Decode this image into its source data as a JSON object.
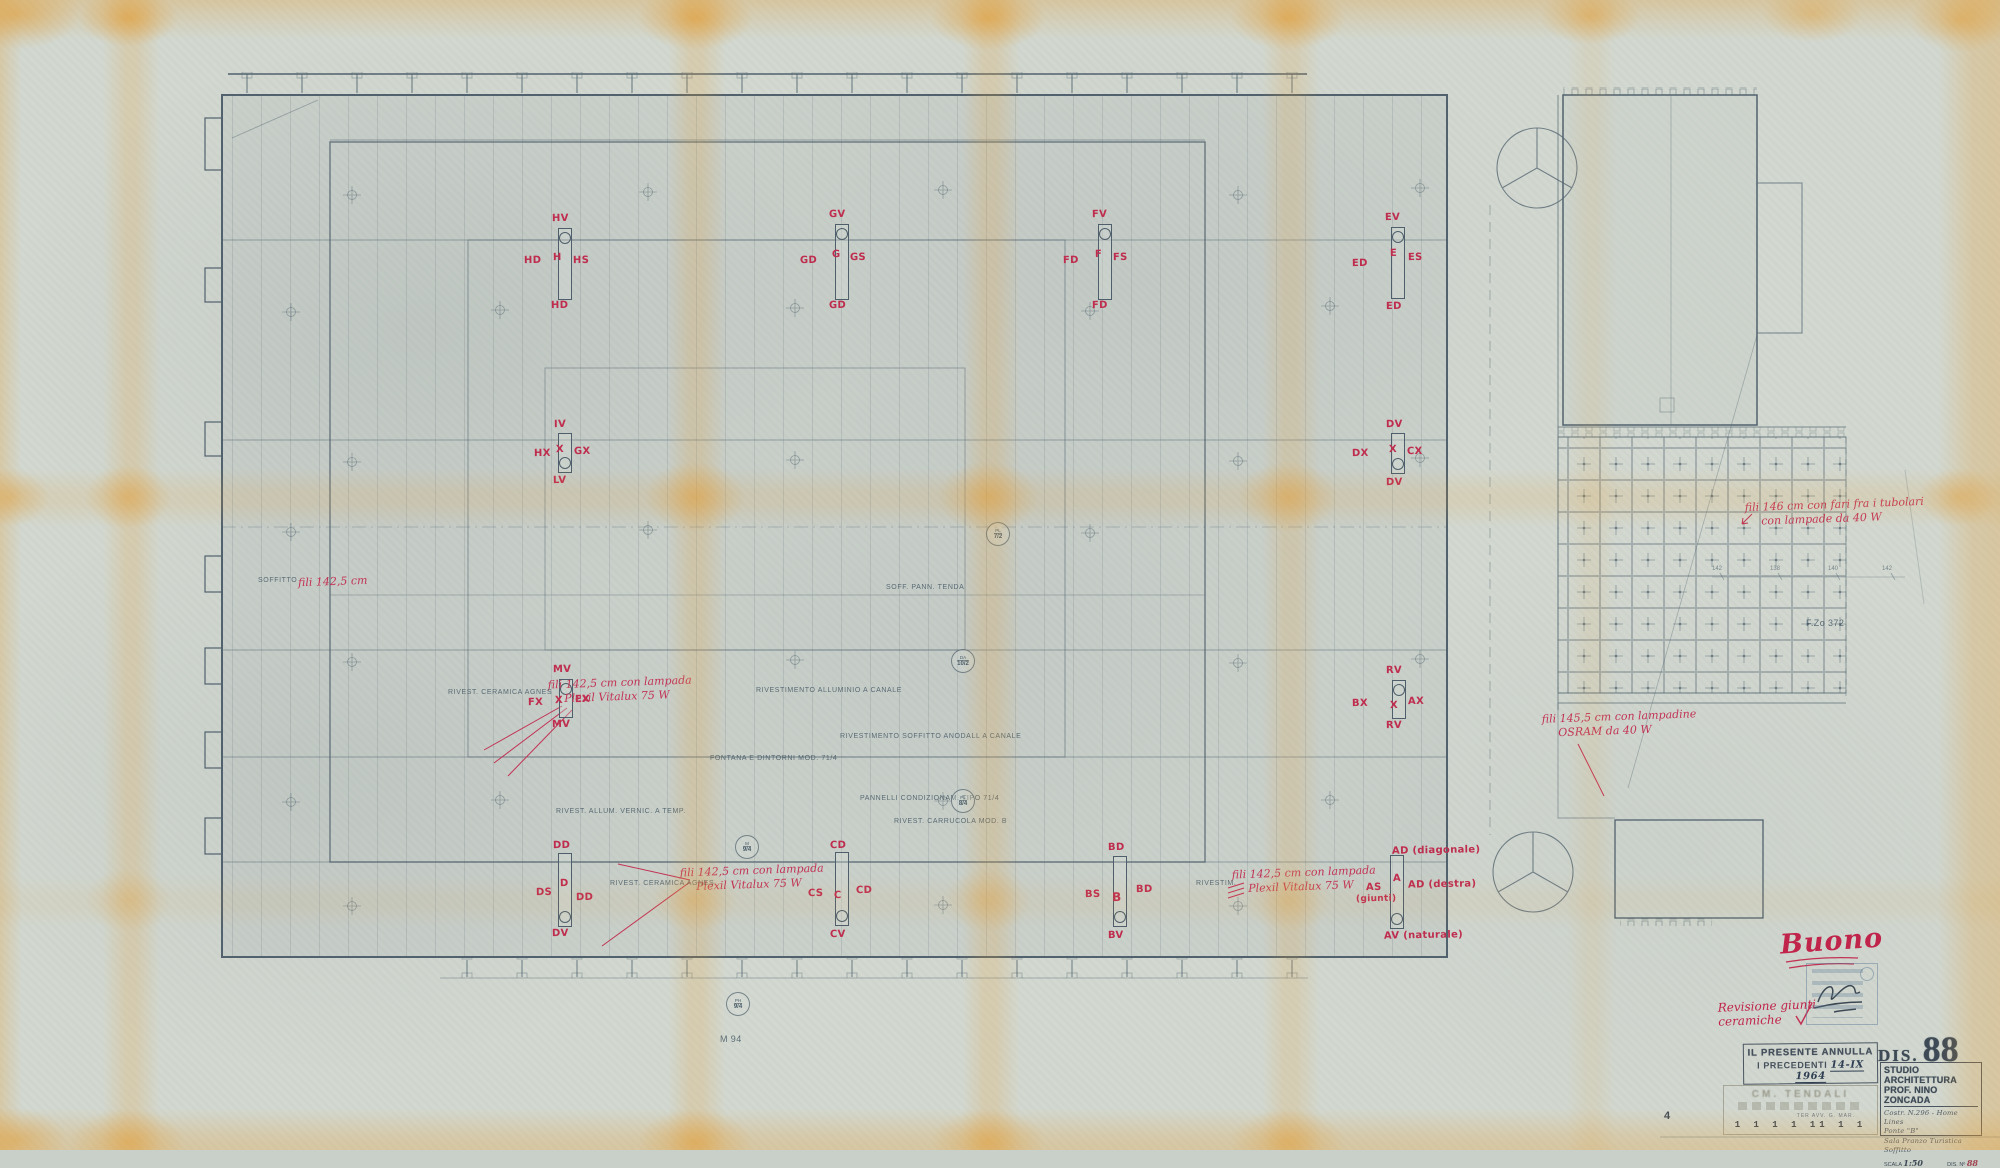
{
  "sheet": {
    "approval": "Buono",
    "revision_line1": "Revisione giunti",
    "revision_line2": "ceramiche",
    "file_ref": "F.Zo 372",
    "bottom_note": "M 94"
  },
  "title_block": {
    "dis_label": "DIS.",
    "dis_number": "88",
    "studio_line1": "STUDIO ARCHITETTURA",
    "studio_line2": "PROF. NINO ZONCADA",
    "project_line1": "Costr. N.296 - Home Lines",
    "project_line2": "Ponte \"B\"",
    "project_line3": "Sala Pranzo Turistica",
    "project_line4": "Soffitto",
    "scale_label": "SCALA",
    "scale_value": "1:50",
    "number_label": "DIS. Nº",
    "number_value": "88"
  },
  "annulla_stamp": {
    "line1": "IL PRESENTE ANNULLA",
    "line2": "I PRECEDENTI",
    "date": "14-IX 1964"
  },
  "materials_stamp": {
    "title": "CM. TENDALI",
    "columns": "TER AVV. G. MAR.",
    "values": "1 1 1 1 11 1 1",
    "left_number": "4"
  },
  "red_annotations": {
    "left_edge": "fili 142,5 cm",
    "a1_line1": "fili 142,5 cm con lampada",
    "a1_line2": "Plexil Vitalux 75 W",
    "a2_line1": "fili 142,5 cm con lampada",
    "a2_line2": "Plexil Vitalux 75 W",
    "a3_line1": "fili 142,5 cm con lampada",
    "a3_line2": "Plexil Vitalux 75 W",
    "a4_line1": "fili 146 cm con fari fra i tubolari",
    "a4_line2": "con lampade da 40 W",
    "a5_line1": "fili 145,5 cm con lampadine",
    "a5_line2": "OSRAM da 40 W"
  },
  "fixtures": [
    {
      "top": "HV",
      "left": "HD",
      "center": "H",
      "right": "HS",
      "bottom": "HD"
    },
    {
      "top": "GV",
      "left": "GD",
      "center": "G",
      "right": "GS",
      "bottom": "GD"
    },
    {
      "top": "FV",
      "left": "FD",
      "center": "F",
      "right": "FS",
      "bottom": "FD"
    },
    {
      "top": "EV",
      "left": "ED",
      "center": "E",
      "right": "ES",
      "bottom": "ED"
    },
    {
      "top": "IV",
      "left": "HX",
      "center": "X",
      "right": "GX",
      "bottom": "LV"
    },
    {
      "top": "DV",
      "left": "DX",
      "center": "X",
      "right": "CX",
      "bottom": "DV"
    },
    {
      "top": "MV",
      "left": "FX",
      "center": "X",
      "right": "EX",
      "bottom": "MV"
    },
    {
      "top": "RV",
      "left": "BX",
      "center": "X",
      "right": "AX",
      "bottom": "RV"
    },
    {
      "top": "DD",
      "left": "DS",
      "center": "D",
      "right": "DD",
      "bottom": "DV"
    },
    {
      "top": "CD",
      "left": "CS",
      "center": "C",
      "right": "CD",
      "bottom": "CV"
    },
    {
      "top": "BD",
      "left": "BS",
      "center": "B",
      "right": "BD",
      "bottom": "BV"
    },
    {
      "top": "AD (diagonale)",
      "left": "AS",
      "left_sub": "(giunti)",
      "center": "A",
      "right": "AD (destra)",
      "bottom": "AV (naturale)"
    }
  ],
  "pencil_notes": {
    "soffitto": "SOFFITTO",
    "ceramica1": "RIVEST. CERAMICA AGNES",
    "ceramica2": "RIVEST. CERAMICA AGNES",
    "rivest1": "RIVESTIMENTO ALLUMINIO A CANALE",
    "rivest2": "RIVESTIMENTO SOFFITTO ANODALL A CANALE",
    "pannelli": "PANNELLI CONDIZIONAM. TIPO 71/4",
    "fontana": "FONTANA E DINTORNI MOD. 71/4",
    "rivest3": "RIVEST. ALLUM. VERNIC. A TEMP.",
    "rivest4": "RIVEST. CARRUCOLA MOD. B",
    "tenda": "SOFF. PANN. TENDA",
    "rivestim": "RIVESTIM."
  },
  "detail_bubbles": [
    {
      "top": "PL",
      "bottom": "7/2"
    },
    {
      "top": "DA",
      "bottom": "10/2"
    },
    {
      "top": "PL",
      "bottom": "8/4"
    },
    {
      "top": "M",
      "bottom": "9/4"
    },
    {
      "top": "PH",
      "bottom": "9/4"
    }
  ],
  "dimensions": [
    "142",
    "138",
    "140",
    "142"
  ]
}
